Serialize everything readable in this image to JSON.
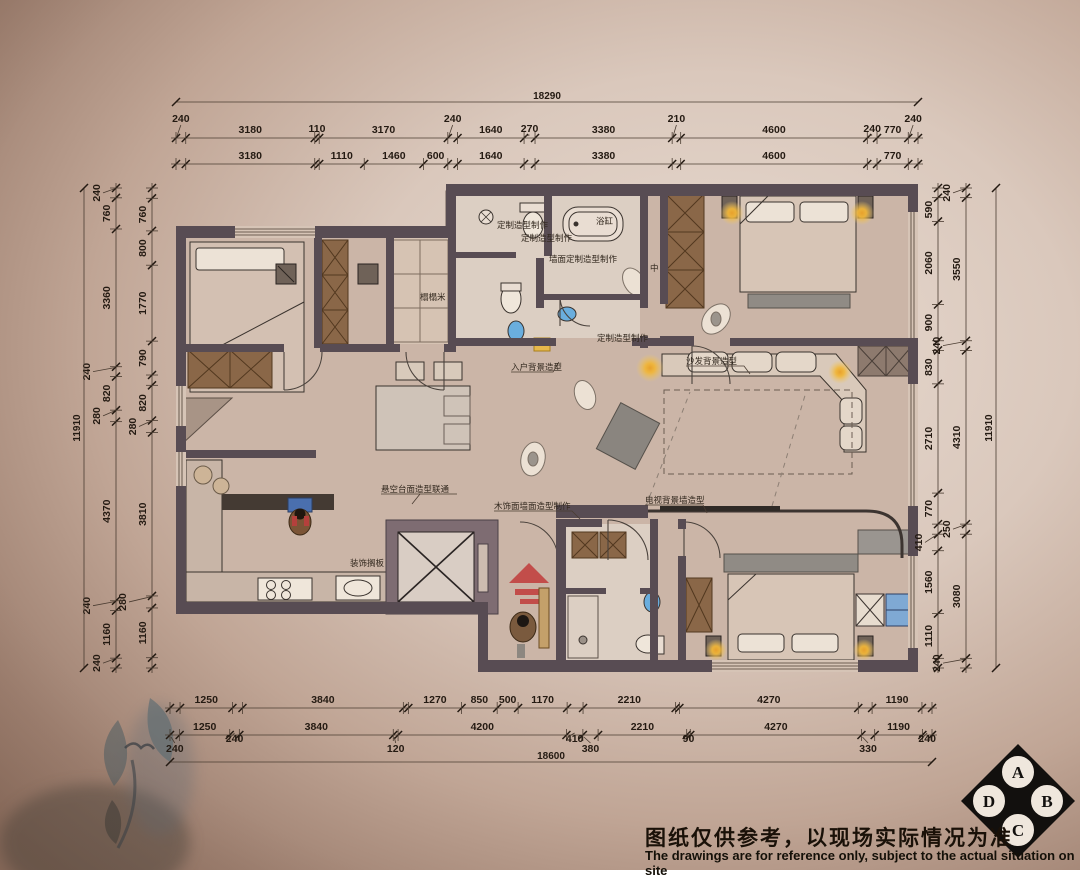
{
  "drawing_title": "residential-floor-plan",
  "dims": {
    "top": {
      "total": "18290",
      "row1": [
        [
          240,
          "240"
        ],
        [
          3180,
          "3180"
        ],
        [
          110,
          "110"
        ],
        [
          3170,
          "3170"
        ],
        [
          240,
          "240"
        ],
        [
          1640,
          "1640"
        ],
        [
          270,
          "270"
        ],
        [
          3380,
          "3380"
        ],
        [
          210,
          "210"
        ],
        [
          4600,
          "4600"
        ],
        [
          240,
          "240"
        ],
        [
          770,
          "770"
        ],
        [
          240,
          "240"
        ]
      ],
      "row2": [
        [
          240,
          ""
        ],
        [
          3180,
          "3180"
        ],
        [
          110,
          ""
        ],
        [
          1110,
          "1110"
        ],
        [
          1460,
          "1460"
        ],
        [
          600,
          "600"
        ],
        [
          240,
          ""
        ],
        [
          1640,
          "1640"
        ],
        [
          270,
          ""
        ],
        [
          3380,
          "3380"
        ],
        [
          210,
          ""
        ],
        [
          4600,
          "4600"
        ],
        [
          240,
          ""
        ],
        [
          770,
          "770"
        ],
        [
          240,
          ""
        ]
      ]
    },
    "bottom": {
      "row1": [
        [
          240,
          ""
        ],
        [
          1250,
          "1250"
        ],
        [
          240,
          ""
        ],
        [
          3840,
          "3840"
        ],
        [
          120,
          ""
        ],
        [
          1270,
          "1270"
        ],
        [
          850,
          "850"
        ],
        [
          500,
          "500"
        ],
        [
          1170,
          "1170"
        ],
        [
          380,
          ""
        ],
        [
          2210,
          "2210"
        ],
        [
          90,
          ""
        ],
        [
          4270,
          "4270"
        ],
        [
          330,
          ""
        ],
        [
          1190,
          "1190"
        ],
        [
          240,
          ""
        ]
      ],
      "row2": [
        [
          240,
          "240"
        ],
        [
          1250,
          "1250"
        ],
        [
          240,
          "240"
        ],
        [
          3840,
          "3840"
        ],
        [
          120,
          "120"
        ],
        [
          4200,
          "4200"
        ],
        [
          410,
          "410"
        ],
        [
          380,
          "380"
        ],
        [
          2210,
          "2210"
        ],
        [
          90,
          "90"
        ],
        [
          4270,
          "4270"
        ],
        [
          330,
          "330"
        ],
        [
          1190,
          "1190"
        ],
        [
          240,
          "240"
        ]
      ],
      "total": "18600"
    },
    "left": {
      "total": "11910",
      "middle": [
        [
          240,
          "240"
        ],
        [
          760,
          "760"
        ],
        [
          3360,
          "3360"
        ],
        [
          240,
          "240"
        ],
        [
          820,
          "820"
        ],
        [
          280,
          "280"
        ],
        [
          4370,
          "4370"
        ],
        [
          240,
          "240"
        ],
        [
          1160,
          "1160"
        ],
        [
          240,
          "240"
        ]
      ],
      "inner": [
        [
          240,
          ""
        ],
        [
          760,
          "760"
        ],
        [
          800,
          "800"
        ],
        [
          1770,
          "1770"
        ],
        [
          790,
          "790"
        ],
        [
          240,
          ""
        ],
        [
          820,
          "820"
        ],
        [
          280,
          "280"
        ],
        [
          3810,
          "3810"
        ],
        [
          280,
          "280"
        ],
        [
          1160,
          "1160"
        ],
        [
          240,
          ""
        ]
      ]
    },
    "right": {
      "total": "11910",
      "middle": [
        [
          240,
          "240"
        ],
        [
          3550,
          "3550"
        ],
        [
          240,
          "240"
        ],
        [
          4310,
          "4310"
        ],
        [
          250,
          "250"
        ],
        [
          3080,
          "3080"
        ],
        [
          240,
          "240"
        ]
      ],
      "inner": [
        [
          240,
          ""
        ],
        [
          590,
          "590"
        ],
        [
          2060,
          "2060"
        ],
        [
          900,
          "900"
        ],
        [
          240,
          ""
        ],
        [
          830,
          "830"
        ],
        [
          2710,
          "2710"
        ],
        [
          770,
          "770"
        ],
        [
          250,
          ""
        ],
        [
          410,
          "410"
        ],
        [
          1560,
          "1560"
        ],
        [
          1110,
          "1110"
        ],
        [
          240,
          ""
        ]
      ]
    }
  },
  "plan": {
    "annotations": [
      {
        "t": "定制造型制作",
        "x": 497,
        "y": 228
      },
      {
        "t": "定制造型制作",
        "x": 521,
        "y": 241
      },
      {
        "t": "浴缸",
        "x": 596,
        "y": 224
      },
      {
        "t": "墙面定制造型制作",
        "x": 549,
        "y": 262
      },
      {
        "t": "定制造型制作",
        "x": 597,
        "y": 341
      },
      {
        "t": "入户背景造型",
        "x": 511,
        "y": 370
      },
      {
        "t": "沙发背景造型",
        "x": 686,
        "y": 364
      },
      {
        "t": "电视背景墙造型",
        "x": 645,
        "y": 503
      },
      {
        "t": "悬空台面造型联通",
        "x": 381,
        "y": 492
      },
      {
        "t": "木饰面墙面造型制作",
        "x": 494,
        "y": 509
      },
      {
        "t": "榻榻米",
        "x": 420,
        "y": 300
      },
      {
        "t": "装饰搁板",
        "x": 350,
        "y": 566
      },
      {
        "t": "中",
        "x": 650,
        "y": 271
      }
    ]
  },
  "compass": {
    "top": "A",
    "right": "B",
    "bottom": "C",
    "left": "D"
  },
  "disclaimer": {
    "zh": "图纸仅供参考，以现场实际情况为准",
    "en": "The drawings are for reference only, subject to the actual situation on site"
  },
  "colors": {
    "wall": "#584C53",
    "wall_light": "#7E6C72",
    "floor": "#CBB5A7",
    "floor_bath": "#DCCFC3",
    "cabinet_brown": "#8A6748",
    "accent_red": "#C24D4A",
    "lamp_glow": "#F0B63A",
    "sink_blue": "#6AAEDE",
    "dim_text": "#241A12"
  }
}
